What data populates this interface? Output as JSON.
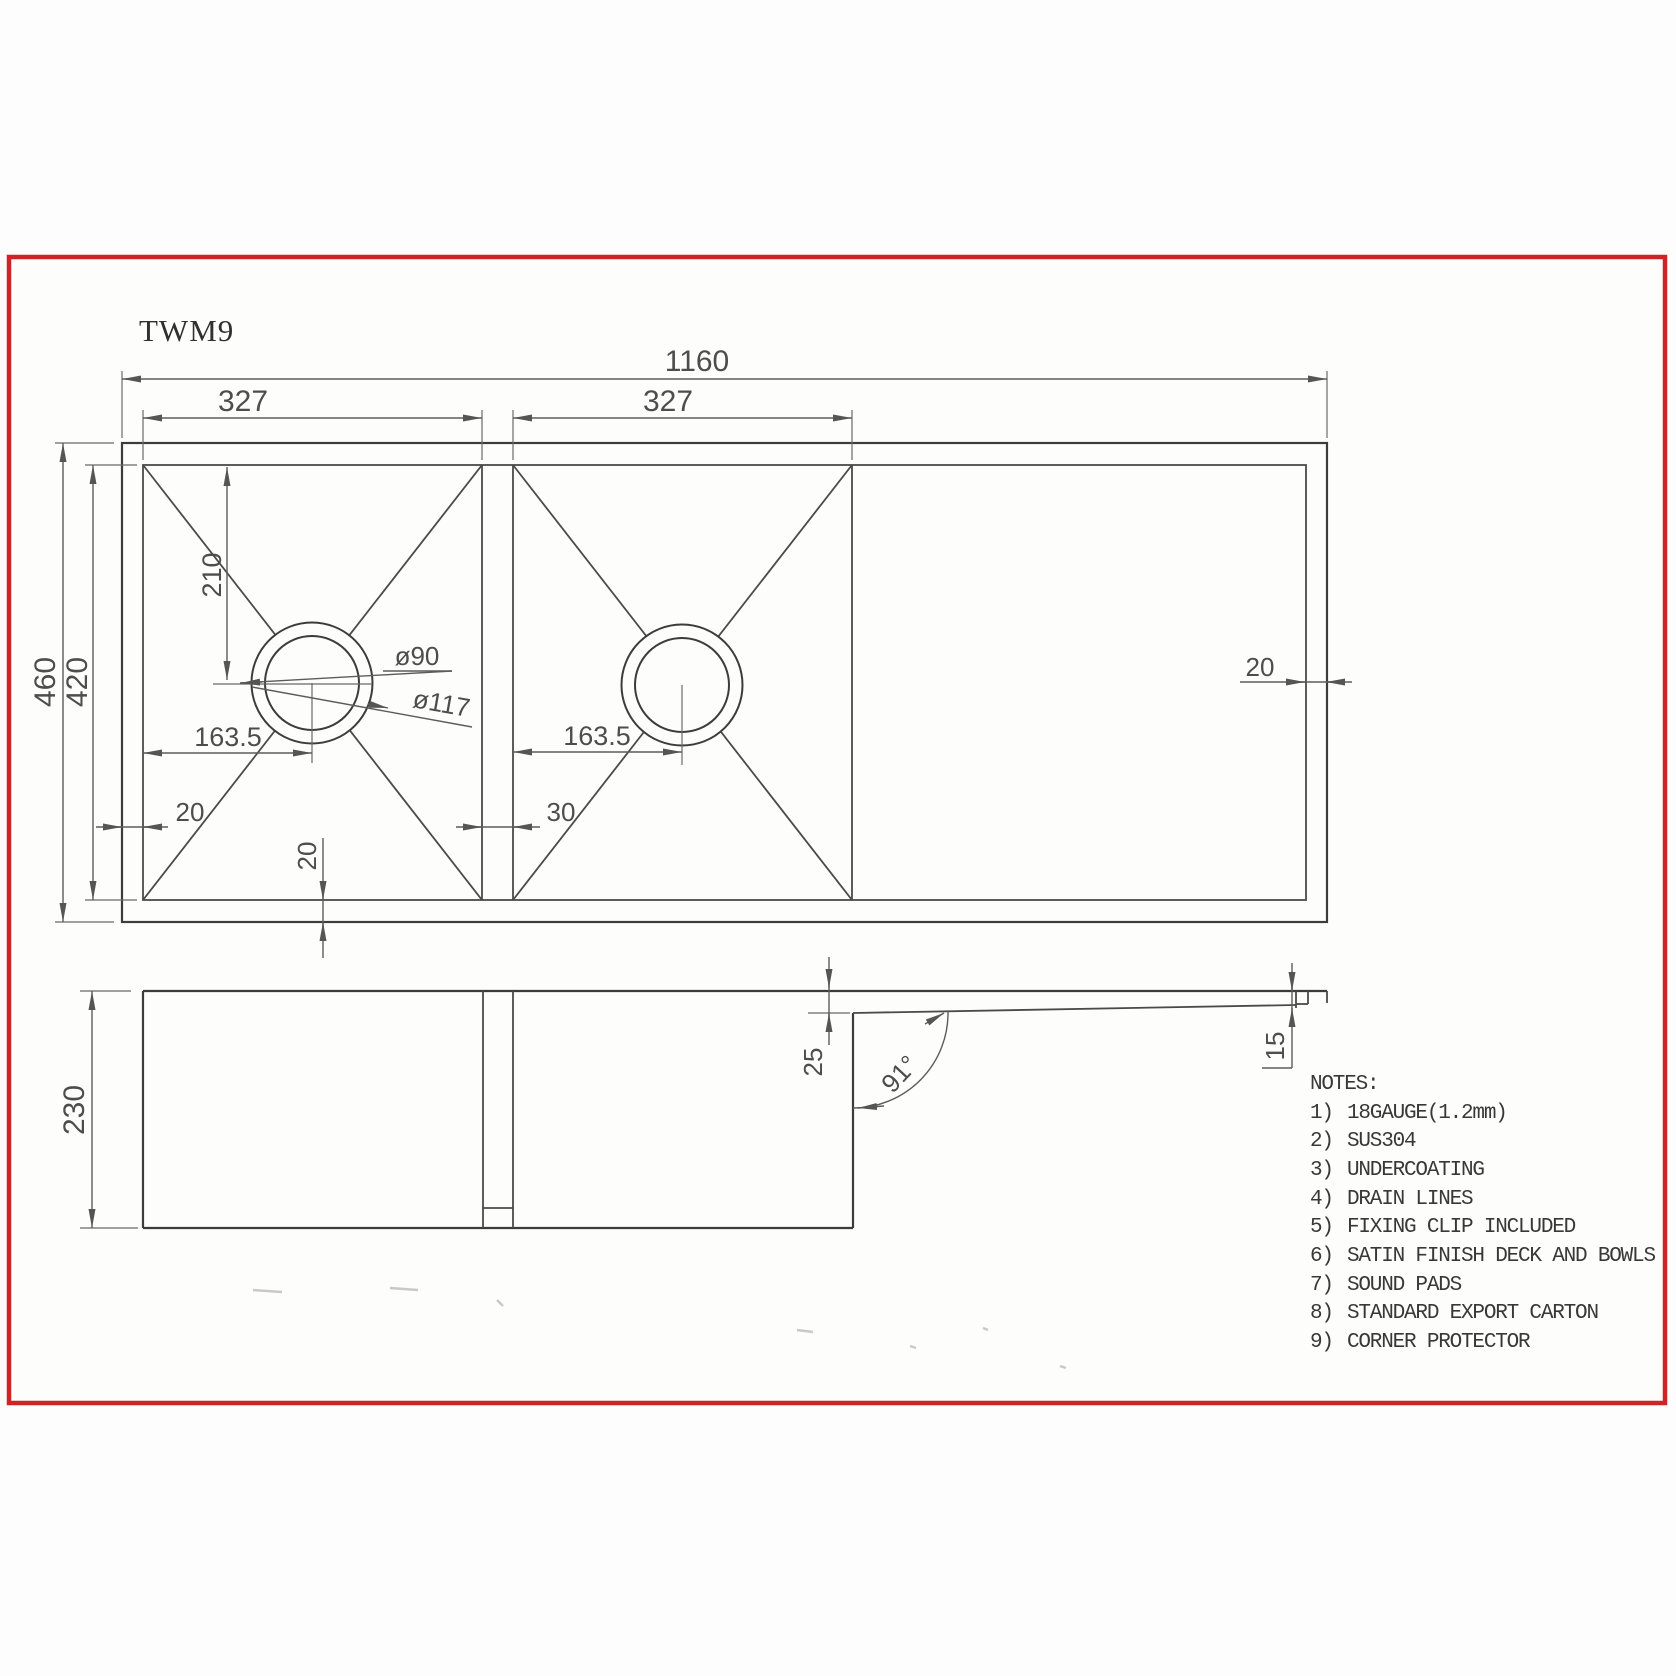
{
  "title": {
    "model": "TWM9"
  },
  "top_view": {
    "overall_width": "1160",
    "bowl1_width": "327",
    "bowl2_width": "327",
    "overall_depth": "460",
    "inner_depth": "420",
    "drain_center_from_top": "210",
    "bowl1_drain_from_left": "163.5",
    "bowl2_drain_from_left": "163.5",
    "left_wall_thickness": "20",
    "divider_thickness": "30",
    "bottom_wall_thickness": "20",
    "right_wall_thickness": "20",
    "drain_hole_diameter": "ø90",
    "drain_flange_diameter": "ø117"
  },
  "side_view": {
    "bowl_depth": "230",
    "drainer_recess": "25",
    "drainer_angle": "91°",
    "edge_step": "15"
  },
  "notes": {
    "heading": "NOTES:",
    "items": [
      {
        "num": "1)",
        "text": "18GAUGE(1.2mm)"
      },
      {
        "num": "2)",
        "text": "SUS304"
      },
      {
        "num": "3)",
        "text": "UNDERCOATING"
      },
      {
        "num": "4)",
        "text": "DRAIN LINES"
      },
      {
        "num": "5)",
        "text": "FIXING CLIP INCLUDED"
      },
      {
        "num": "6)",
        "text": "SATIN FINISH DECK AND BOWLS"
      },
      {
        "num": "7)",
        "text": "SOUND PADS"
      },
      {
        "num": "8)",
        "text": "STANDARD EXPORT CARTON"
      },
      {
        "num": "9)",
        "text": "CORNER PROTECTOR"
      }
    ]
  },
  "colors": {
    "border": "#cd2424",
    "line": "#3c3c3c",
    "dim_text": "#4d4d4d"
  }
}
